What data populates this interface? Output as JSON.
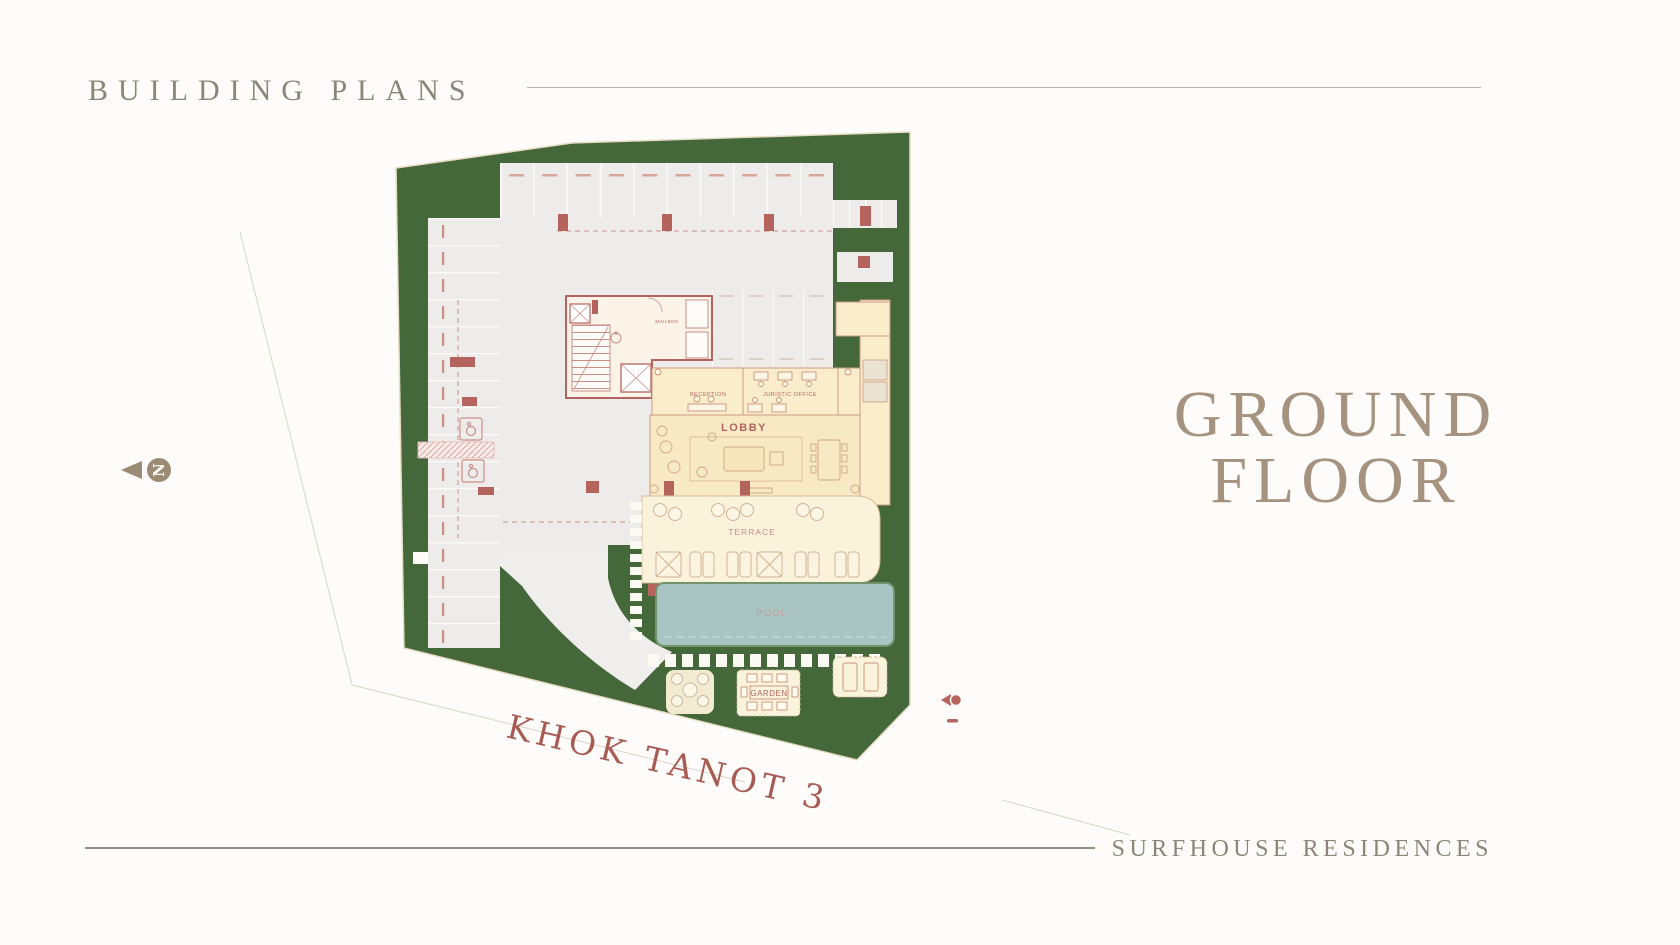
{
  "header": {
    "title": "BUILDING PLANS"
  },
  "floor_title": {
    "line1": "GROUND",
    "line2": "FLOOR"
  },
  "footer": {
    "brand": "SURFHOUSE RESIDENCES"
  },
  "plan": {
    "street_name": "KHOK TANOT 3",
    "compass_letter": "N",
    "labels": {
      "lobby": "LOBBY",
      "reception": "RECEPTION",
      "juristic_office": "JURISTIC OFFICE",
      "terrace": "TERRACE",
      "pool": "POOL",
      "garden": "GARDEN",
      "mailbox": "MAILBOX"
    },
    "colors": {
      "site_green": "#44683A",
      "parking_gray": "#EDECEA",
      "plan_red": "#B4645C",
      "cream": "#FAEDCB",
      "pool_blue": "#A9C4C2",
      "street_text": "#A85B53",
      "heading_text": "#8B8677",
      "floor_title_text": "#A5937F",
      "compass_tan": "#9C8B74"
    }
  }
}
